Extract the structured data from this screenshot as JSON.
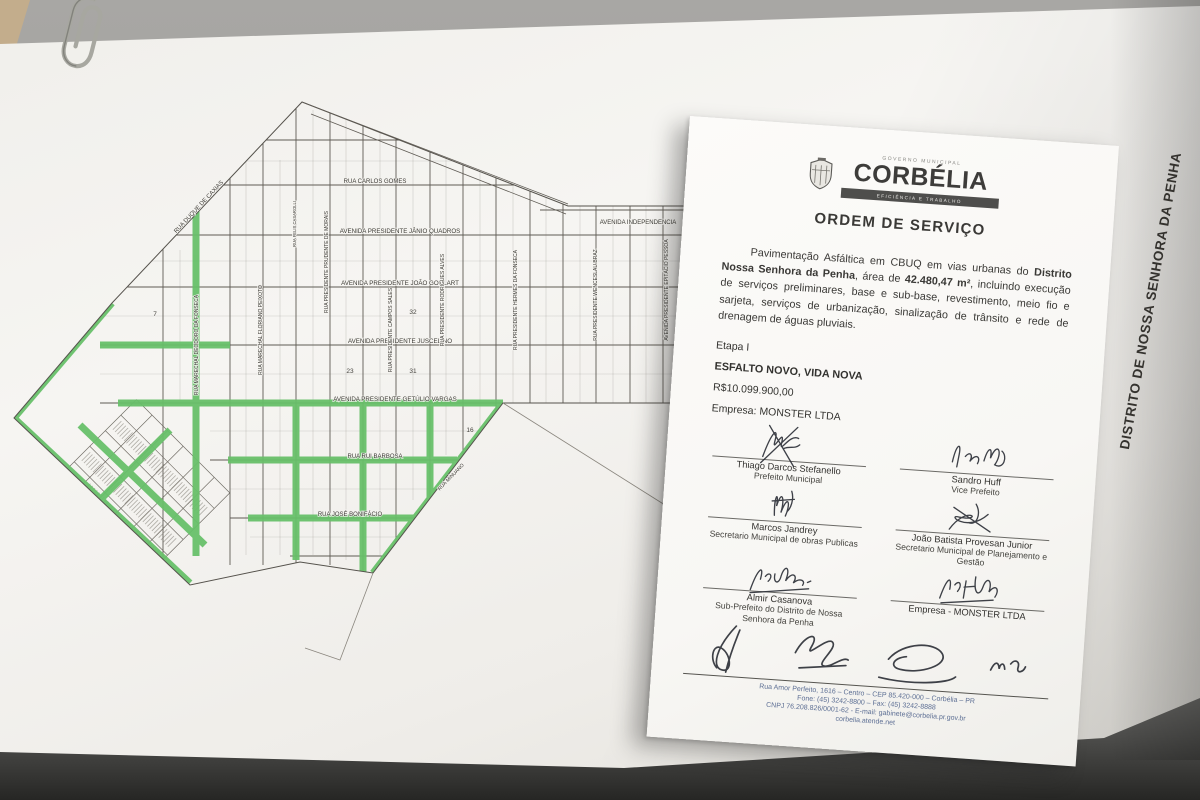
{
  "map": {
    "vertical_title": "DISTRITO DE NOSSA SENHORA DA PENHA",
    "highlight_color": "#68c06a",
    "street_labels": [
      "RUA DUQUE DE CAXIAS",
      "RUA CARLOS GOMES",
      "AVENIDA PRESIDENTE JÂNIO QUADROS",
      "AVENIDA INDEPENDENCIA",
      "AVENIDA PRESIDENTE JOÃO GOULART",
      "AVENIDA PRESIDENTE JUSCELINO",
      "AVENIDA PRESIDENTE GETÚLIO VARGAS",
      "RUA RUI BARBOSA",
      "RUA JOSÉ BONIFÁCIO",
      "RUA MARECHAL DEODORO DA FONSECA",
      "RUA MARECHAL FLORIANO PEIXOTO",
      "RUA PRESIDENTE PRUDENTE DE MORAIS",
      "RUA PRESIDENTE CAMPOS SALES",
      "RUA PRESIDENTE RODRIGUES ALVES",
      "RUA PRESIDENTE HERMES DA FONSECA",
      "RUA PRESIDENTE WENCESLAU BRAZ",
      "AVENIDA PRESIDENTE EPITÁCIO PESSOA",
      "RUA FELIX CASAROLLI",
      "RUA MINUANO"
    ],
    "block_numbers": [
      "7",
      "23",
      "31",
      "32",
      "16"
    ]
  },
  "document": {
    "header_small": "GOVERNO MUNICIPAL",
    "city_name": "CORBÉLIA",
    "motto": "EFICIÊNCIA E TRABALHO",
    "title": "ORDEM DE SERVIÇO",
    "body": {
      "seg1": "Pavimentação Asfáltica em CBUQ em vias urbanas do ",
      "bold1": "Distrito Nossa Senhora da Penha",
      "seg2": ", área de ",
      "bold2": "42.480,47 m²",
      "seg3": ", incluindo execução de serviços preliminares, base e sub-base, revestimento, meio fio e sarjeta, serviços de urbanização, sinalização de trânsito e rede de drenagem de águas pluviais."
    },
    "etapa": "Etapa I",
    "project": "ESFALTO NOVO, VIDA NOVA",
    "amount": "R$10.099.900,00",
    "company": "Empresa: MONSTER LTDA",
    "signatories": [
      {
        "name": "Thiago Darcos Stefanello",
        "role": "Prefeito Municipal"
      },
      {
        "name": "Sandro Huff",
        "role": "Vice Prefeito"
      },
      {
        "name": "Marcos Jandrey",
        "role": "Secretario Municipal de obras Publicas"
      },
      {
        "name": "João Batista Provesan Junior",
        "role": "Secretario Municipal de Planejamento e Gestão"
      },
      {
        "name": "Almir Casanova",
        "role": "Sub-Prefeito do Distrito de Nossa Senhora da Penha"
      },
      {
        "name": "Empresa - MONSTER LTDA",
        "role": ""
      }
    ],
    "footer": {
      "line1": "Rua Amor Perfeito, 1616 – Centro – CEP 85.420-000 – Corbélia – PR",
      "line2": "Fone: (45) 3242-8800 – Fax: (45) 3242-8888",
      "line3": "CNPJ 76.208.826/0001-62 - E-mail: gabinete@corbelia.pr.gov.br",
      "line4": "corbelia.atende.net"
    }
  }
}
